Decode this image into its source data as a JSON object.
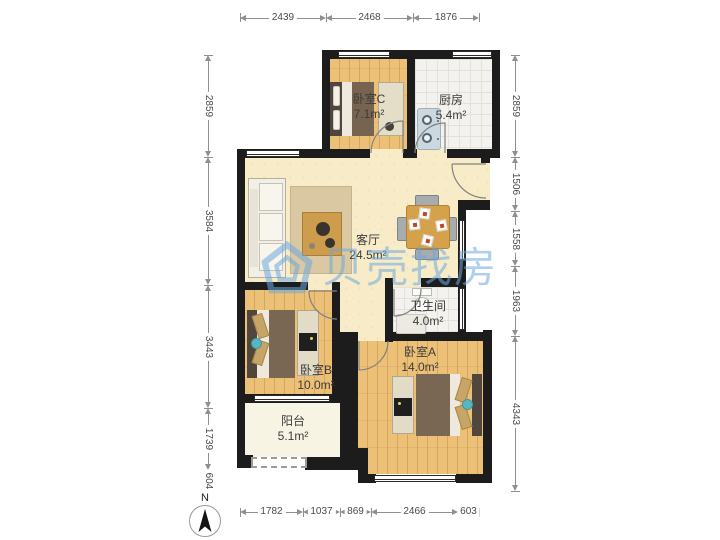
{
  "compass": {
    "label": "N"
  },
  "watermark": {
    "text": "贝壳找房"
  },
  "rooms": {
    "bedroomC": {
      "name": "卧室C",
      "area": "7.1m²"
    },
    "kitchen": {
      "name": "厨房",
      "area": "5.4m²"
    },
    "living": {
      "name": "客厅",
      "area": "24.5m²"
    },
    "bathroom": {
      "name": "卫生间",
      "area": "4.0m²"
    },
    "bedroomB": {
      "name": "卧室B",
      "area": "10.0m²"
    },
    "bedroomA": {
      "name": "卧室A",
      "area": "14.0m²"
    },
    "balcony": {
      "name": "阳台",
      "area": "5.1m²"
    }
  },
  "dimensions": {
    "top": [
      "2439",
      "2468",
      "1876"
    ],
    "bottom": [
      "1782",
      "1037",
      "869",
      "2466",
      "603"
    ],
    "left": [
      "2859",
      "3584",
      "3443",
      "1739",
      "604"
    ],
    "right": [
      "2859",
      "1506",
      "1558",
      "1963",
      "4343"
    ]
  },
  "colors": {
    "wall": "#1c1c1c",
    "wood": "#ecc177",
    "cream": "#f8ecc8",
    "watermark": "#6ca8de"
  }
}
